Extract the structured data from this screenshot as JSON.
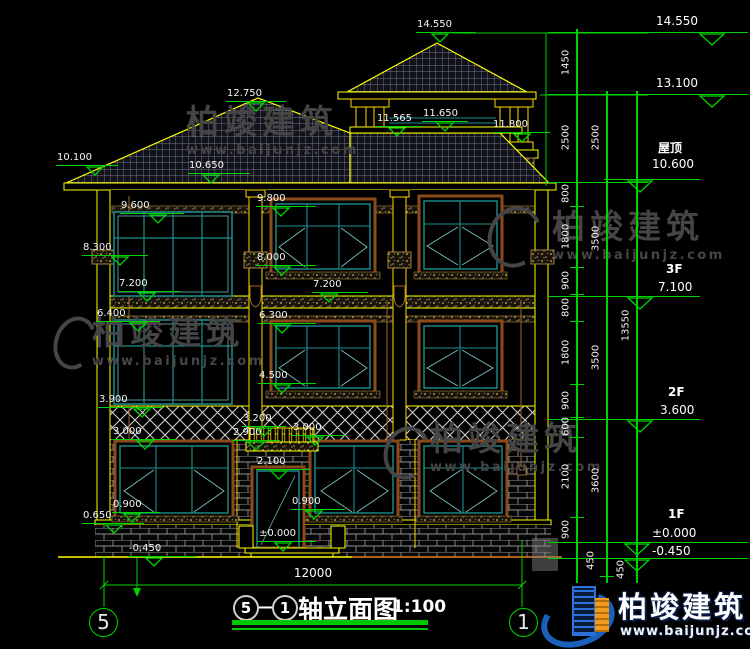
{
  "watermark": {
    "name": "柏竣建筑",
    "url": "www.baijunjz.com"
  },
  "logo": {
    "name": "柏竣建筑",
    "url": "www.baijunjz.com"
  },
  "title": {
    "axis_start": "5",
    "dash": "—",
    "axis_end": "1",
    "text": "轴立面图",
    "scale": "1:100"
  },
  "axes": {
    "left": "5",
    "right": "1"
  },
  "overall_dim": {
    "label": "12000"
  },
  "marks": {
    "left": [
      {
        "label": "10.100",
        "lx": 56,
        "ly": 166,
        "len": 62,
        "tri": 95
      },
      {
        "label": "9.600",
        "lx": 120,
        "ly": 214,
        "len": 64,
        "tri": 158
      },
      {
        "label": "8.300",
        "lx": 82,
        "ly": 256,
        "len": 66,
        "tri": 120
      },
      {
        "label": "7.200",
        "lx": 118,
        "ly": 292,
        "len": 62,
        "tri": 147
      },
      {
        "label": "6.400",
        "lx": 96,
        "ly": 322,
        "len": 64,
        "tri": 138
      },
      {
        "label": "3.900",
        "lx": 98,
        "ly": 408,
        "len": 66,
        "tri": 142
      },
      {
        "label": "3.000",
        "lx": 112,
        "ly": 440,
        "len": 64,
        "tri": 145
      },
      {
        "label": "0.650",
        "lx": 82,
        "ly": 524,
        "len": 62,
        "tri": 114
      },
      {
        "label": "0.900",
        "lx": 112,
        "ly": 513,
        "len": 48,
        "tri": 132
      },
      {
        "label": "-0.450",
        "lx": 128,
        "ly": 557,
        "len": 68,
        "tri": 154
      }
    ],
    "center": [
      {
        "label": "14.550",
        "lx": 416,
        "ly": 33,
        "len": 60,
        "tri": 440
      },
      {
        "label": "12.750",
        "lx": 226,
        "ly": 102,
        "len": 60,
        "tri": 256
      },
      {
        "label": "11.650",
        "lx": 422,
        "ly": 122,
        "len": 46,
        "tri": 445
      },
      {
        "label": "11.565",
        "lx": 376,
        "ly": 127,
        "len": 44,
        "tri": 397
      },
      {
        "label": "11.800",
        "lx": 492,
        "ly": 133,
        "len": 58,
        "tri": 522
      },
      {
        "label": "10.650",
        "lx": 188,
        "ly": 174,
        "len": 62,
        "tri": 211
      },
      {
        "label": "9.800",
        "lx": 256,
        "ly": 207,
        "len": 60,
        "tri": 281
      },
      {
        "label": "8.000",
        "lx": 256,
        "ly": 266,
        "len": 60,
        "tri": 282
      },
      {
        "label": "7.200",
        "lx": 312,
        "ly": 293,
        "len": 56,
        "tri": 329
      },
      {
        "label": "6.300",
        "lx": 258,
        "ly": 324,
        "len": 58,
        "tri": 282
      },
      {
        "label": "4.500",
        "lx": 258,
        "ly": 384,
        "len": 58,
        "tri": 282
      },
      {
        "label": "3.200",
        "lx": 242,
        "ly": 427,
        "len": 44,
        "tri": 264
      },
      {
        "label": "2.900",
        "lx": 232,
        "ly": 441,
        "len": 48,
        "tri": 256
      },
      {
        "label": "3.000",
        "lx": 292,
        "ly": 436,
        "len": 54,
        "tri": 315
      },
      {
        "label": "2.100",
        "lx": 256,
        "ly": 470,
        "len": 54,
        "tri": 279
      },
      {
        "label": "0.900",
        "lx": 291,
        "ly": 510,
        "len": 54,
        "tri": 314
      },
      {
        "label": "±0.000",
        "lx": 258,
        "ly": 542,
        "len": 58,
        "tri": 283
      }
    ],
    "right": [
      {
        "floor": "",
        "label": "14.550",
        "textx": 656,
        "texty": 14,
        "lx": 626,
        "len": 122,
        "ly": 33,
        "tri": 712
      },
      {
        "floor": "",
        "label": "13.100",
        "textx": 656,
        "texty": 76,
        "lx": 626,
        "len": 122,
        "ly": 95,
        "tri": 712
      },
      {
        "floor": "屋顶",
        "label": "10.600",
        "floorx": 658,
        "floory": 139,
        "textx": 652,
        "texty": 157,
        "lx": 604,
        "len": 96,
        "ly": 180,
        "tri": 640
      },
      {
        "floor": "3F",
        "label": "7.100",
        "floorx": 666,
        "floory": 262,
        "textx": 658,
        "texty": 280,
        "lx": 604,
        "len": 96,
        "ly": 297,
        "tri": 640
      },
      {
        "floor": "2F",
        "label": "3.600",
        "floorx": 668,
        "floory": 385,
        "textx": 660,
        "texty": 403,
        "lx": 604,
        "len": 96,
        "ly": 420,
        "tri": 640
      },
      {
        "floor": "1F",
        "label": "±0.000",
        "floorx": 668,
        "floory": 507,
        "textx": 652,
        "texty": 526,
        "lx": 608,
        "len": 140,
        "ly": 543,
        "tri": 637
      },
      {
        "floor": "",
        "label": "-0.450",
        "textx": 652,
        "texty": 544,
        "lx": 608,
        "len": 140,
        "ly": 559,
        "tri": 637
      }
    ]
  },
  "chains": {
    "level_lines": [
      33,
      95,
      183,
      297,
      420,
      543,
      559
    ],
    "columns": [
      {
        "x": 577,
        "ticks": [
          33,
          95,
          183,
          207,
          268,
          295,
          322,
          385,
          418,
          438,
          518,
          543,
          559
        ],
        "labels": [
          "1450",
          "2500",
          "800",
          "1800",
          "900",
          "800",
          "1800",
          "900",
          "600",
          "2100",
          "900",
          "450"
        ]
      },
      {
        "x": 607,
        "ticks": [
          95,
          183,
          297,
          420,
          543,
          577
        ],
        "labels": [
          "2500",
          "3500",
          "3500",
          "3600",
          "450"
        ]
      },
      {
        "x": 637,
        "ticks": [
          95,
          559
        ],
        "labels": [
          "13550"
        ]
      }
    ]
  }
}
